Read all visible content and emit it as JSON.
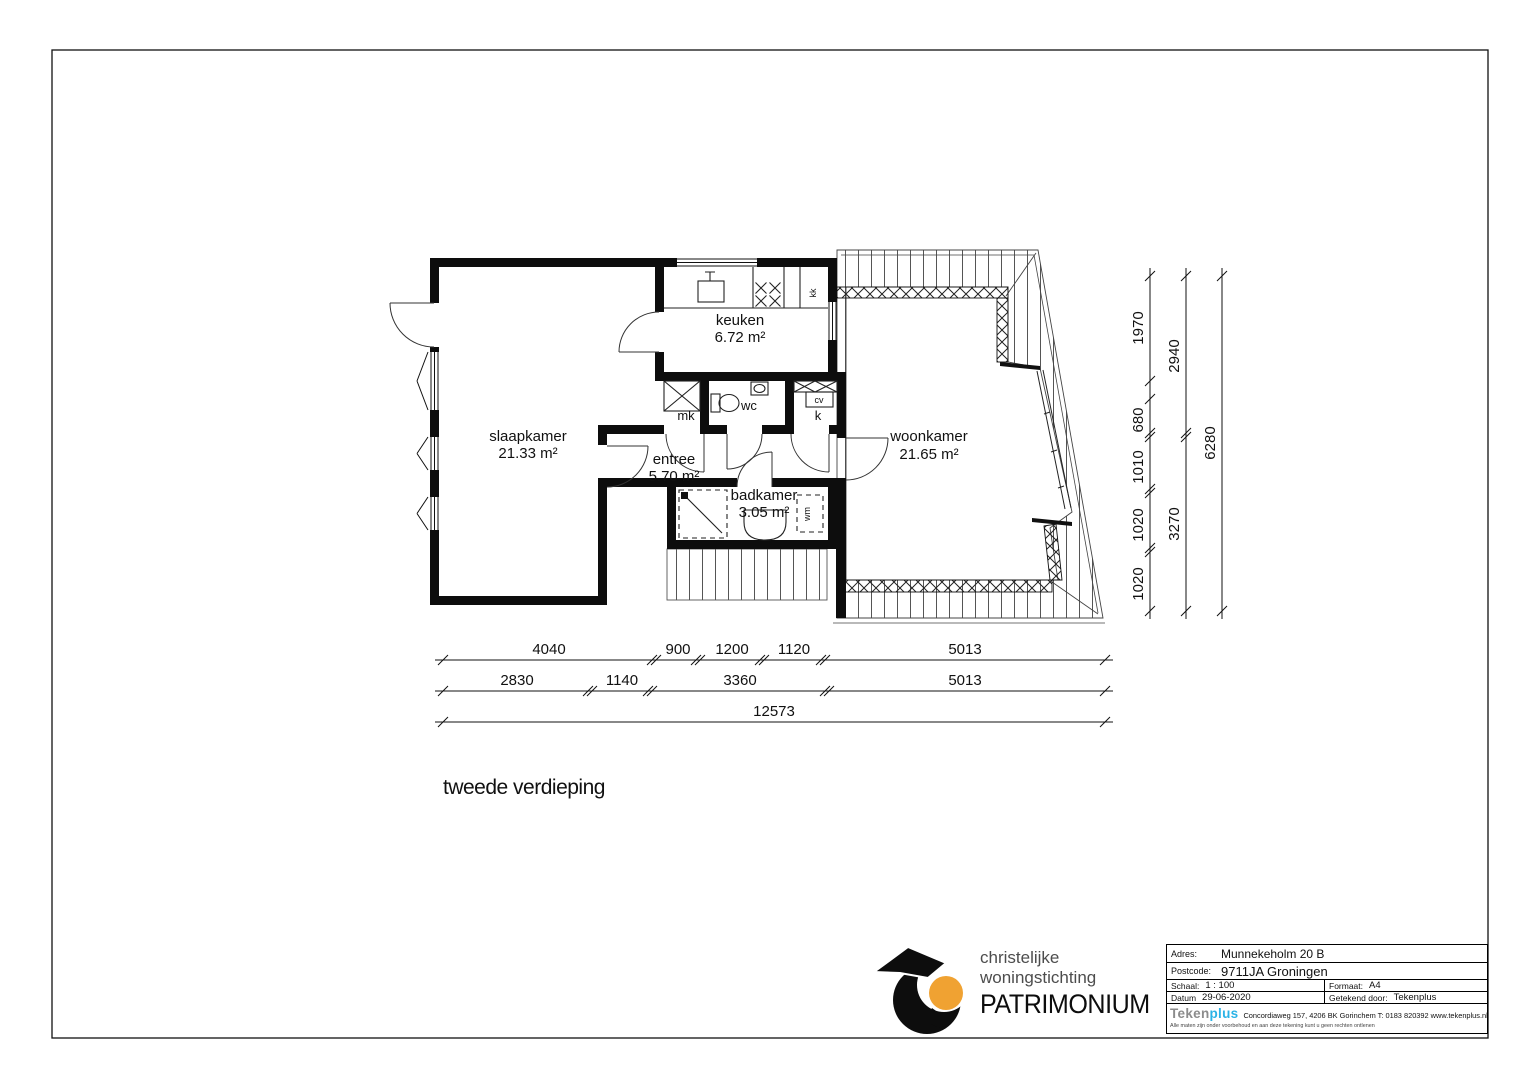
{
  "drawing": {
    "floor_label": "tweede verdieping",
    "rooms": {
      "slaapkamer": {
        "name": "slaapkamer",
        "area": "21.33 m²"
      },
      "keuken": {
        "name": "keuken",
        "area": "6.72 m²"
      },
      "entree": {
        "name": "entree",
        "area": "5.70 m²"
      },
      "badkamer": {
        "name": "badkamer",
        "area": "3.05 m²"
      },
      "woonkamer": {
        "name": "woonkamer",
        "area": "21.65 m²"
      }
    },
    "closets": {
      "mk": "mk",
      "wc": "wc",
      "k": "k",
      "kk": "kk",
      "cv": "cv",
      "wm": "wm"
    },
    "dims": {
      "bottom_row1": [
        "4040",
        "900",
        "1200",
        "1120",
        "5013"
      ],
      "bottom_row2": [
        "2830",
        "1140",
        "3360",
        "5013"
      ],
      "bottom_total": "12573",
      "right_col1": [
        "1970",
        "680",
        "1010",
        "1020",
        "1020"
      ],
      "right_col2": [
        "2940",
        "3270"
      ],
      "right_total": "6280"
    }
  },
  "title_block": {
    "adres_label": "Adres:",
    "adres": "Munnekeholm 20 B",
    "postcode_label": "Postcode:",
    "postcode": "9711JA Groningen",
    "schaal_label": "Schaal:",
    "schaal": "1 : 100",
    "formaat_label": "Formaat:",
    "formaat": "A4",
    "datum_label": "Datum",
    "datum": "29-06-2020",
    "getekend_label": "Getekend door:",
    "getekend": "Tekenplus",
    "firm_name_1": "Teken",
    "firm_name_2": "plus",
    "firm_address": "Concordiaweg 157, 4206 BK Gorinchem  T: 0183 820392 www.tekenplus.nl",
    "disclaimer": "Alle maten zijn onder voorbehoud en aan deze tekening kunt u geen rechten ontlenen"
  },
  "patrimonium": {
    "line1": "christelijke",
    "line2": "woningstichting",
    "line3": "PATRIMONIUM"
  },
  "colors": {
    "ink": "#111111",
    "logo_orange": "#F0A232",
    "logo_cyan": "#2BB3E6",
    "logo_gray": "#8C8C8C"
  }
}
